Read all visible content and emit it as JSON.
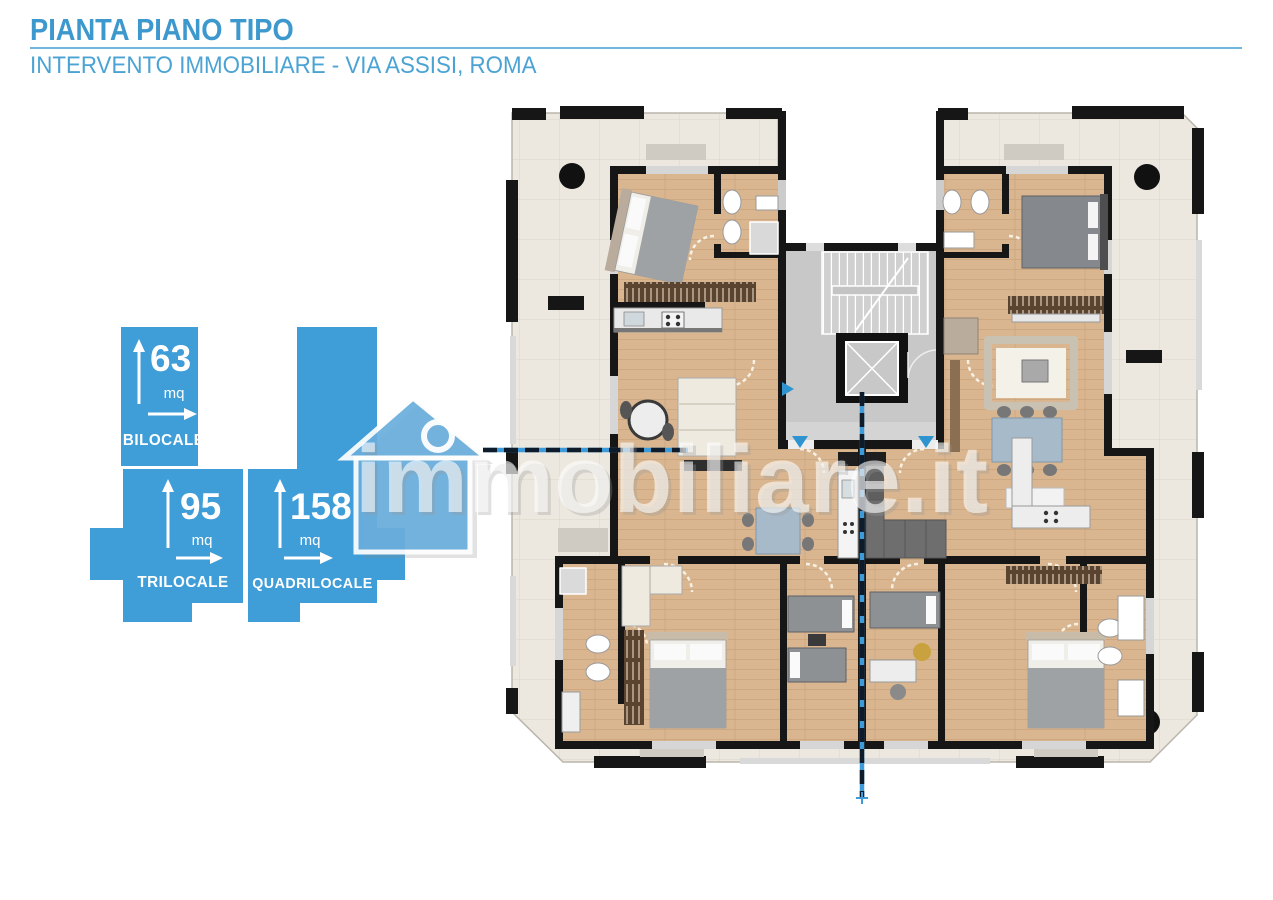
{
  "header": {
    "title": "PIANTA PIANO TIPO",
    "subtitle": "INTERVENTO IMMOBILIARE - VIA ASSISI, ROMA"
  },
  "legend": {
    "units": [
      {
        "label": "BILOCALE",
        "area": "63",
        "area_unit": "mq"
      },
      {
        "label": "TRILOCALE",
        "area": "95",
        "area_unit": "mq"
      },
      {
        "label": "QUADRILOCALE",
        "area": "158",
        "area_unit": "mq"
      }
    ]
  },
  "watermark": {
    "text": "immobiliare.it"
  },
  "colors": {
    "accent_blue": "#3f9dd8",
    "title_blue": "#3d98ce",
    "terrace_tile": "#ece8df",
    "wood_floor": "#d9b690",
    "wall_black": "#161616",
    "core_gray": "#c8c8c8",
    "section_line_blue": "#3e9bd9"
  }
}
